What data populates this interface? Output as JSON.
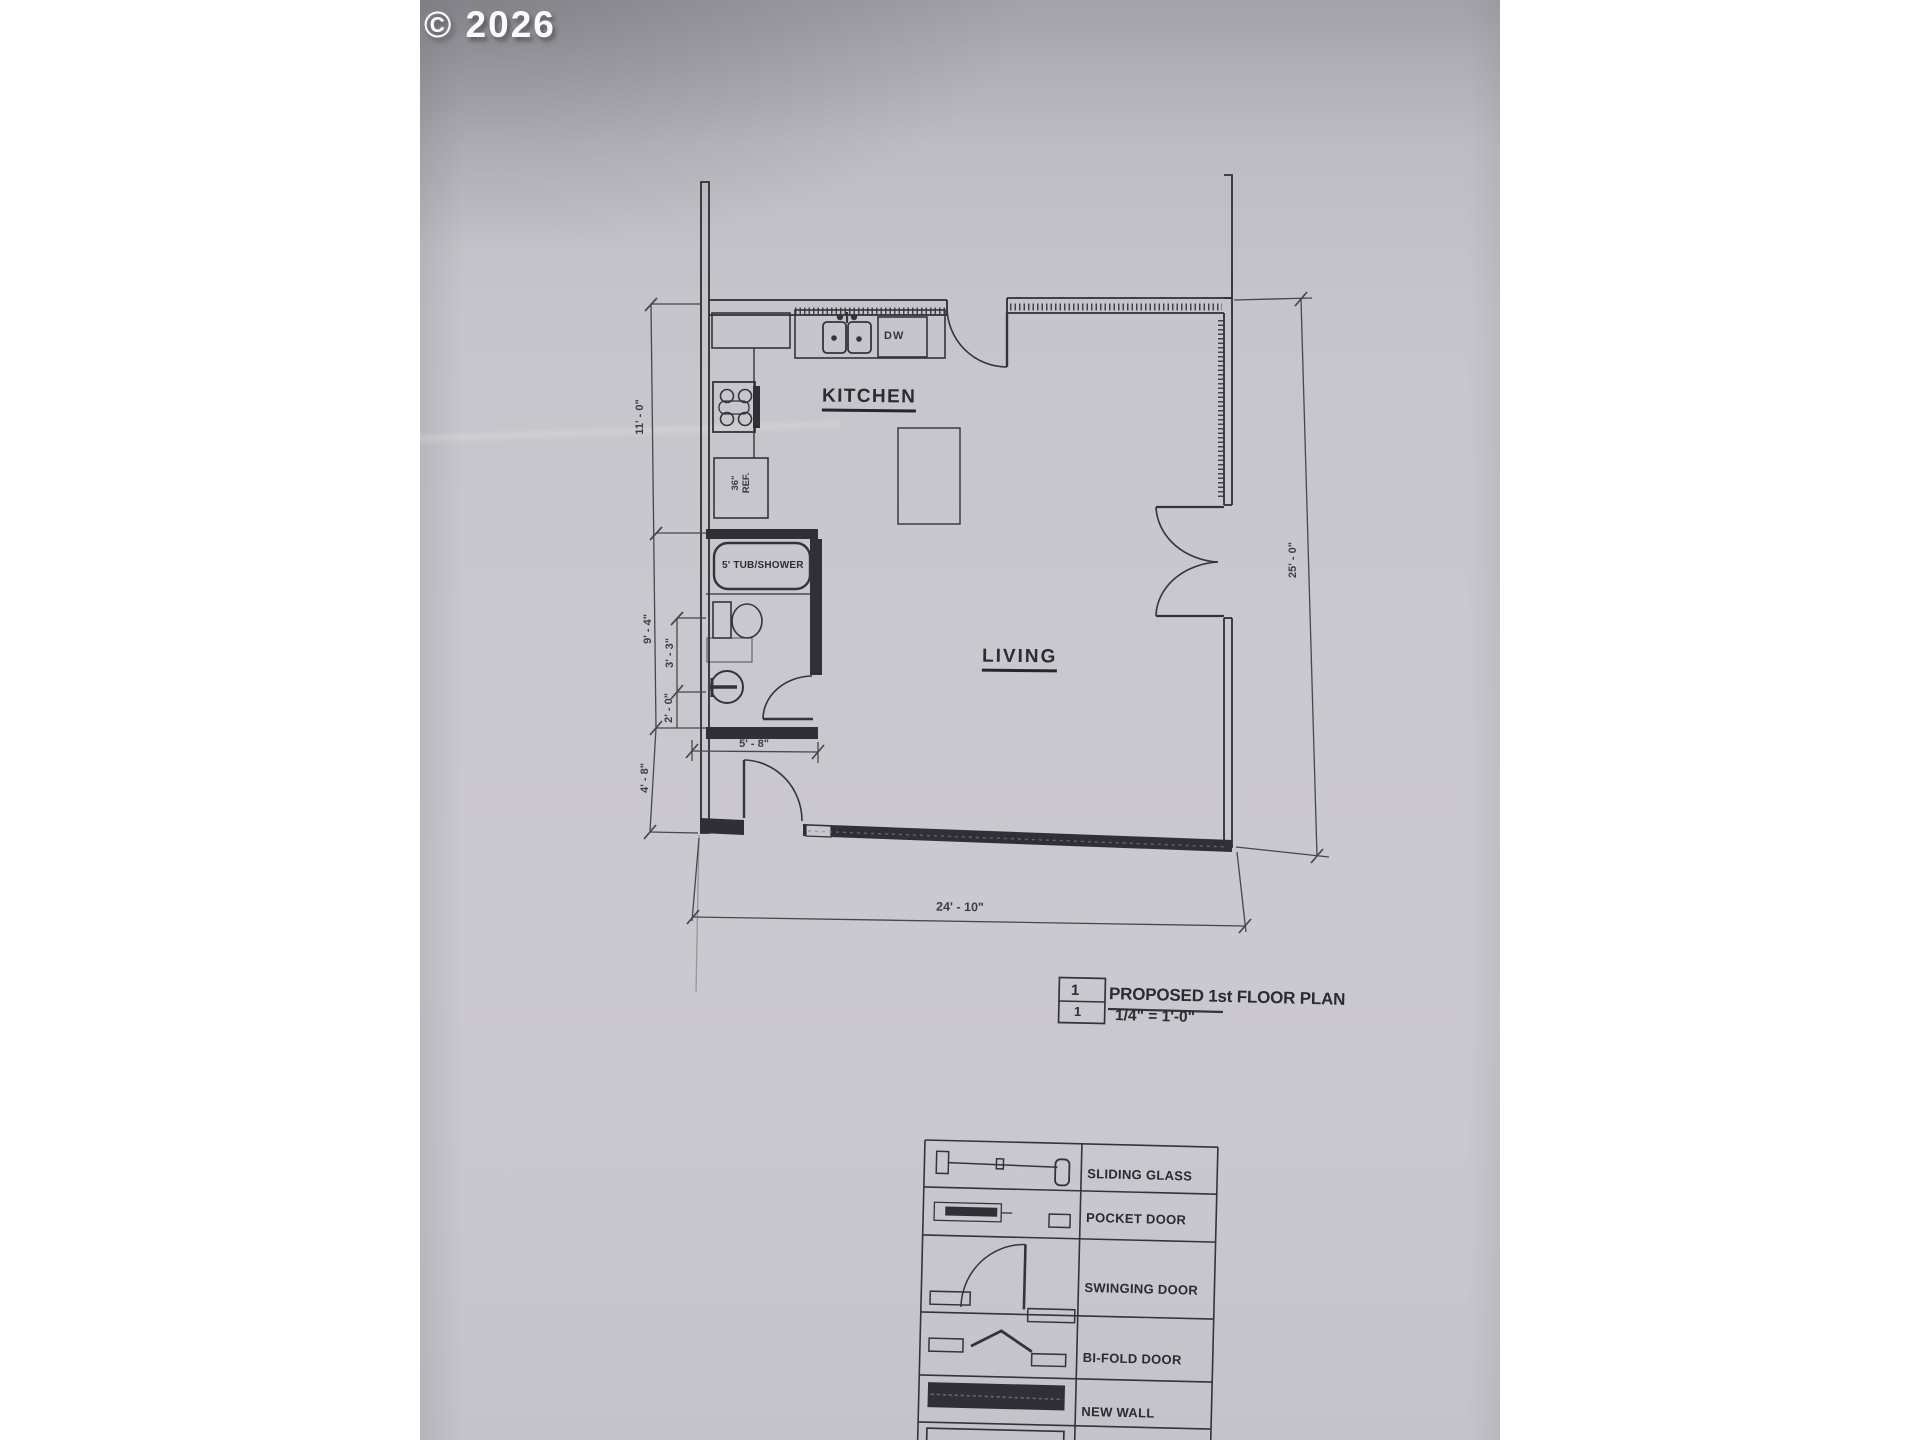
{
  "photo": {
    "copyright": "© 2026"
  },
  "plan": {
    "rooms": [
      {
        "label": "KITCHEN"
      },
      {
        "label": "LIVING"
      }
    ],
    "fixtures": {
      "dishwasher_label": "DW",
      "fridge_line1": "36\"",
      "fridge_line2": "REF.",
      "tub_label": "5' TUB/SHOWER"
    },
    "dimensions": {
      "kitchen_height": "11' - 0\"",
      "bath_height": "9' - 4\"",
      "bath_sub_upper": "3' - 3\"",
      "bath_sub_lower": "2' - 0\"",
      "entry_height": "4' - 8\"",
      "bath_width": "5' - 8\"",
      "overall_height": "25' - 0\"",
      "overall_width": "24' - 10\""
    }
  },
  "title_block": {
    "detail_number": "1",
    "sheet_number": "1",
    "title": "PROPOSED 1st FLOOR PLAN",
    "scale": "1/4\" = 1'-0\""
  },
  "legend": {
    "rows": [
      {
        "label": "SLIDING GLASS"
      },
      {
        "label": "POCKET DOOR"
      },
      {
        "label": "SWINGING DOOR"
      },
      {
        "label": "BI-FOLD DOOR"
      },
      {
        "label": "NEW WALL"
      }
    ]
  },
  "colors": {
    "paper": "#c7c6cc",
    "ink": "#2f2f35",
    "dim": "#46464c"
  }
}
